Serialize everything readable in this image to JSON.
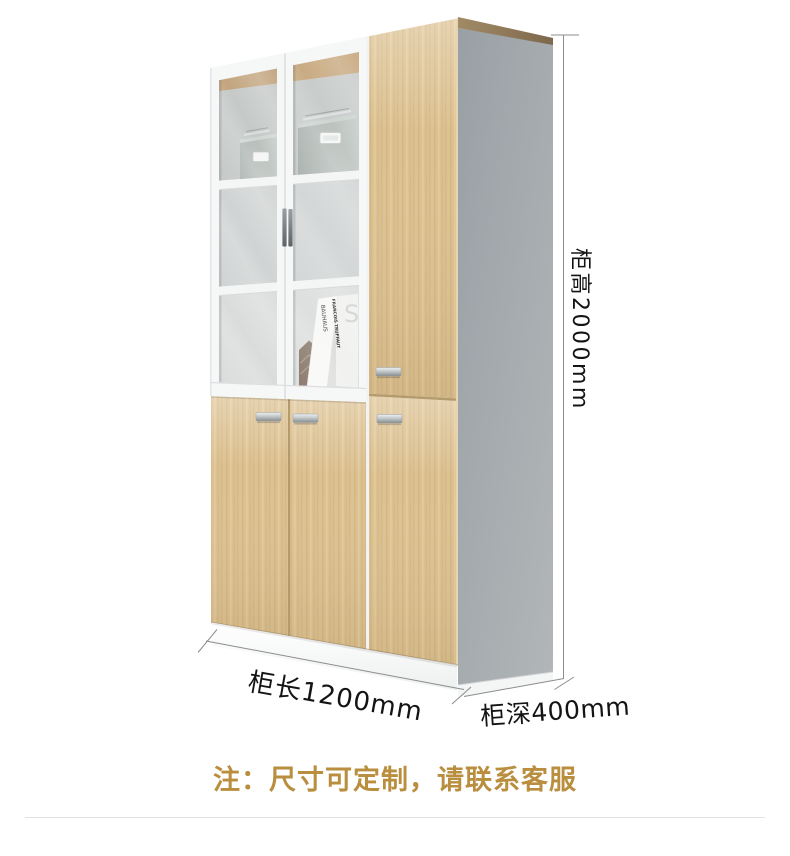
{
  "product_view": {
    "type": "cabinet-product-render",
    "colors": {
      "wood": "#dcc192",
      "wood_top_edge": "#8d7454",
      "side_panel_gray": "#a4aaae",
      "door_frame_white": "#f6f7f7",
      "handle_silver": "#b9bec0",
      "storage_box_sage": "#b7c0bb"
    },
    "decor": {
      "book_spine_title": "FRANCOIS TRUFFAUT",
      "book_spine_subtitle": "BAUHAUS",
      "book_back_initial": "S"
    }
  },
  "dimensions": {
    "height_label": "柜高2000mm",
    "length_label": "柜长1200mm",
    "depth_label": "柜深400mm"
  },
  "note": {
    "text": "注：尺寸可定制，请联系客服",
    "color": "#b98e3e"
  }
}
